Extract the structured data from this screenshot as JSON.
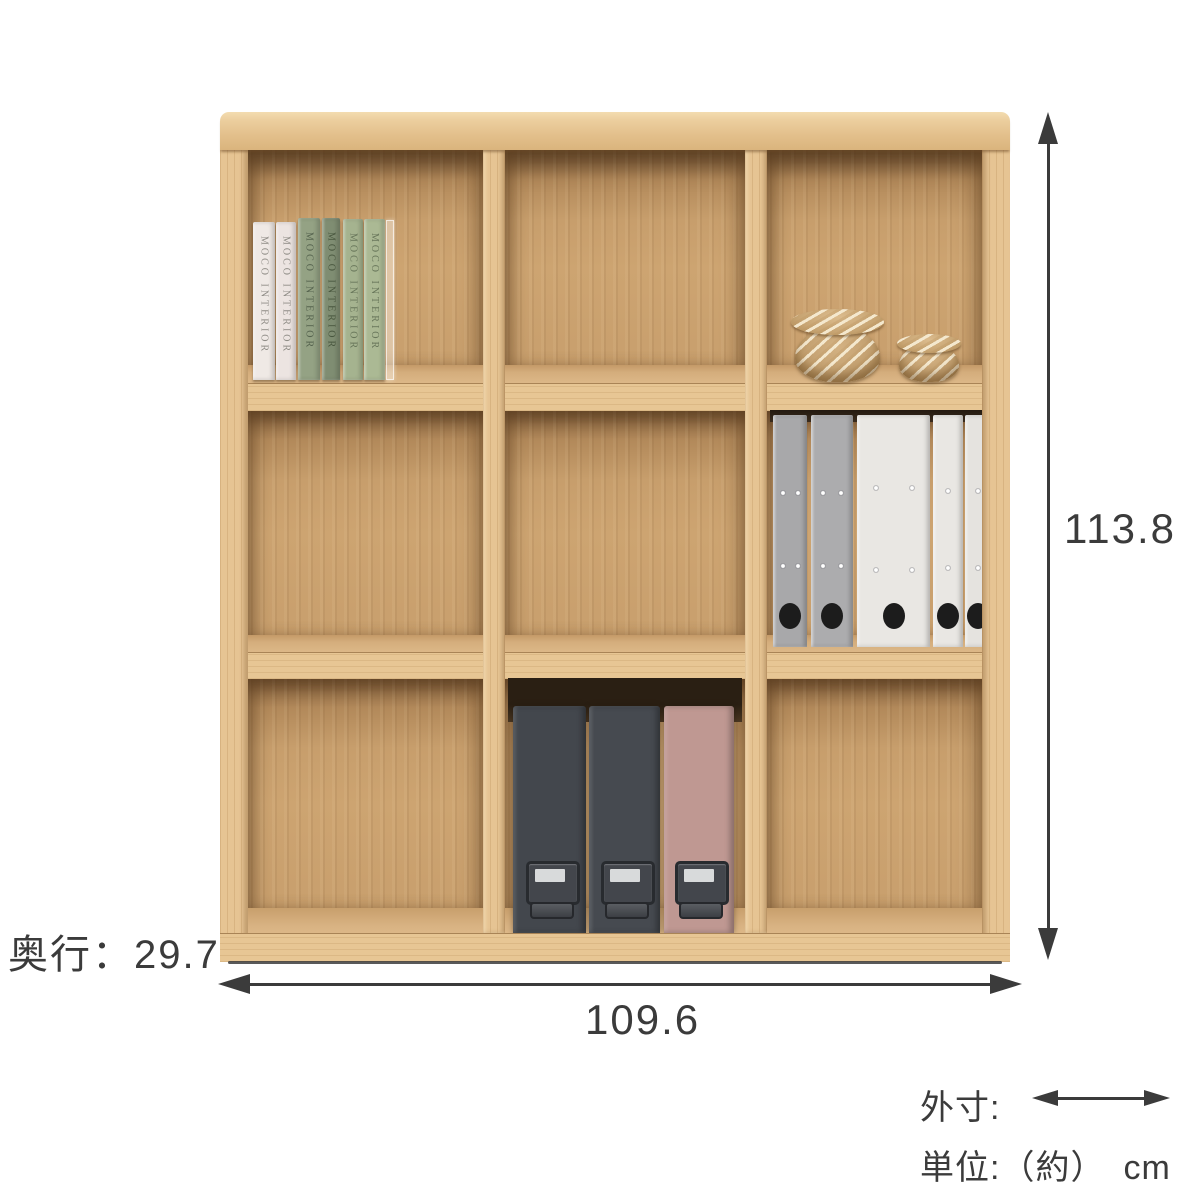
{
  "diagram": {
    "dimensions": {
      "height": "113.8",
      "width": "109.6",
      "depth": "奥行：29.7"
    },
    "legend": {
      "outer_dim_label": "外寸:",
      "unit_label": "単位:（約）　cm",
      "arrow_icon": "double-headed-arrow"
    },
    "annotation_color": "#3b3b3b",
    "bookshelf": {
      "grid": "3x3 open shelf",
      "material_colors": {
        "frame": "#e6c493",
        "frame_light": "#f0d6a9",
        "interior_back": "#c9a06c",
        "interior_shadow": "#7a5a38",
        "shelf_top": "#d9b383"
      },
      "contents": {
        "books": {
          "spine_text": "MOCO INTERIOR",
          "count": 6,
          "colors": [
            "#efe9e5",
            "#ece4e1",
            "#94a284",
            "#7f8d72",
            "#a5b38f",
            "#abb994"
          ],
          "text_colors": [
            "#8f8c86",
            "#8f8c86",
            "#55634e",
            "#49573f",
            "#68765a",
            "#68765a"
          ]
        },
        "baskets": {
          "count": 2,
          "color": "#c3a070",
          "weave_color": "#f2e7cf"
        },
        "binders": {
          "count": 5,
          "colors": [
            "#a8a8aa",
            "#acacae",
            "#e9e7e3",
            "#e9e7e3",
            "#e5e3df"
          ],
          "hole_color": "#1c1c1c"
        },
        "file_boxes": {
          "count": 3,
          "colors": [
            "#43474d",
            "#464a50",
            "#bf9892"
          ],
          "hardware_color": "#3a3d42",
          "label_color": "#d8dadb"
        }
      }
    }
  }
}
